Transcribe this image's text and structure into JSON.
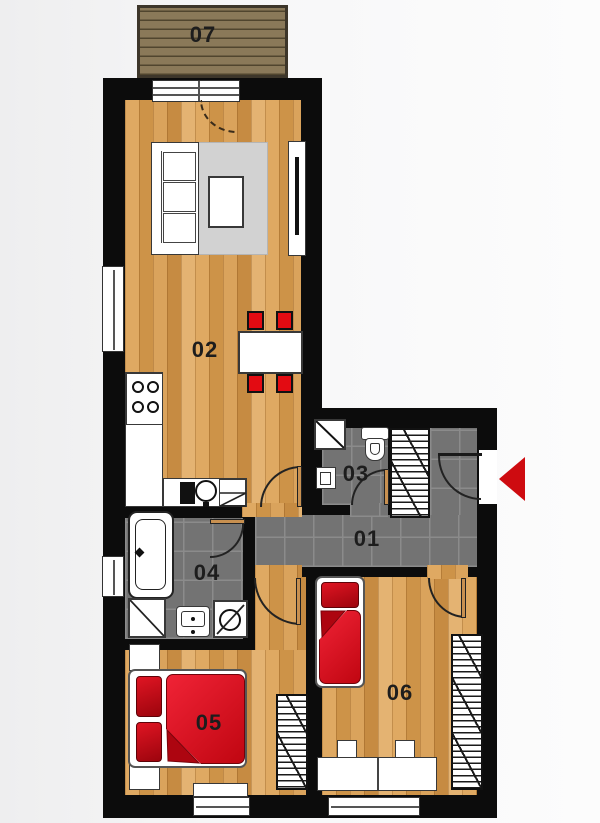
{
  "plan": {
    "type": "apartment-floor-plan",
    "labels": {
      "r01": "01",
      "r02": "02",
      "r03": "03",
      "r04": "04",
      "r05": "05",
      "r06": "06",
      "r07": "07"
    },
    "entrance": {
      "marker": "red-arrow-left"
    }
  },
  "palette": {
    "wall": "#0c0c0c",
    "woodA": "#dfa962",
    "woodB": "#cd9348",
    "deck": "#8a7959",
    "deckLine": "#50452e",
    "deckBorder": "#3d362a",
    "tile": "#737373",
    "grout": "#8b8b8b",
    "red": "#d90d12",
    "redDeep": "#a40710",
    "chairRed": "#e30b12",
    "rug": "#d2d2d2",
    "arrow": "#ce0b10",
    "labelc": "#1d1d1d"
  }
}
